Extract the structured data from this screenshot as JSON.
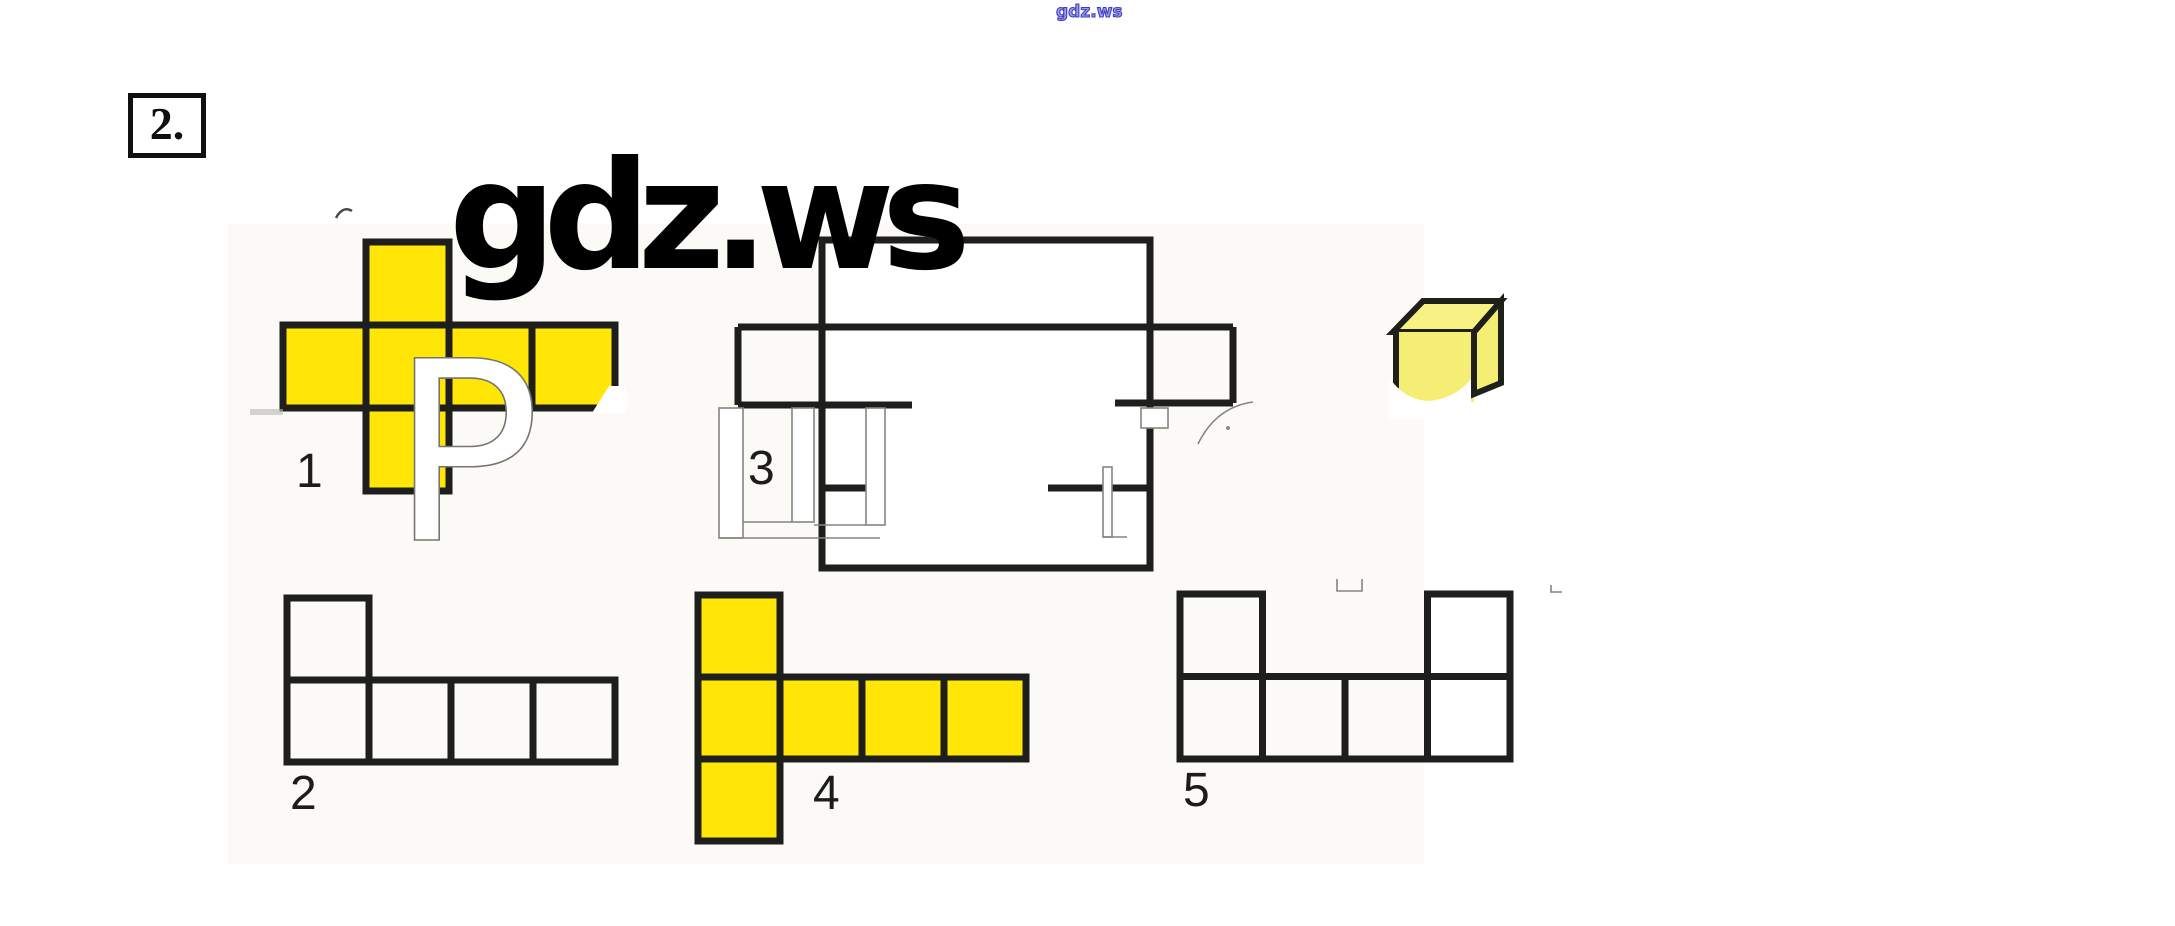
{
  "page": {
    "background": "#ffffff",
    "watermark_top": "gdz.ws",
    "watermark_big": "gdz.ws",
    "problem_number": "2.",
    "colors": {
      "net_yellow": "#FFE606",
      "cube_front_yellow": "#F5EE74",
      "cube_top_yellow": "#F8F183",
      "line_black": "#1E1E1C",
      "faint_gray": "#85857F",
      "watermark_blue": "#3D3DC4"
    }
  },
  "figures": [
    {
      "id": "net-1",
      "label": "1",
      "cell": 83,
      "origin": [
        283,
        242
      ],
      "filled": true,
      "squares": [
        [
          1,
          0
        ],
        [
          0,
          1
        ],
        [
          1,
          1
        ],
        [
          2,
          1
        ],
        [
          3,
          1
        ],
        [
          1,
          2
        ]
      ]
    },
    {
      "id": "net-2",
      "label": "2",
      "cell": 82,
      "origin": [
        287,
        598
      ],
      "filled": false,
      "squares": [
        [
          0,
          0
        ],
        [
          0,
          1
        ],
        [
          1,
          1
        ],
        [
          2,
          1
        ],
        [
          3,
          1
        ]
      ]
    },
    {
      "id": "net-4",
      "label": "4",
      "cell": 82,
      "origin": [
        698,
        595
      ],
      "filled": true,
      "squares": [
        [
          0,
          0
        ],
        [
          0,
          1
        ],
        [
          1,
          1
        ],
        [
          2,
          1
        ],
        [
          3,
          1
        ],
        [
          0,
          2
        ]
      ]
    },
    {
      "id": "net-5",
      "label": "5",
      "cell": 82.5,
      "origin": [
        1180,
        594
      ],
      "filled": false,
      "squares": [
        [
          0,
          0
        ],
        [
          3,
          0
        ],
        [
          0,
          1
        ],
        [
          1,
          1
        ],
        [
          2,
          1
        ],
        [
          3,
          1
        ]
      ]
    }
  ],
  "figure3": {
    "label": "3",
    "rect": [
      822,
      240,
      328,
      328
    ],
    "segments": [
      [
        738,
        327,
        1233,
        327
      ],
      [
        738,
        327,
        738,
        405
      ],
      [
        738,
        405,
        912,
        405
      ],
      [
        1115,
        403,
        1233,
        403
      ],
      [
        1233,
        327,
        1233,
        403
      ],
      [
        822,
        488,
        876,
        488
      ],
      [
        1048,
        488,
        1150,
        488
      ]
    ]
  }
}
